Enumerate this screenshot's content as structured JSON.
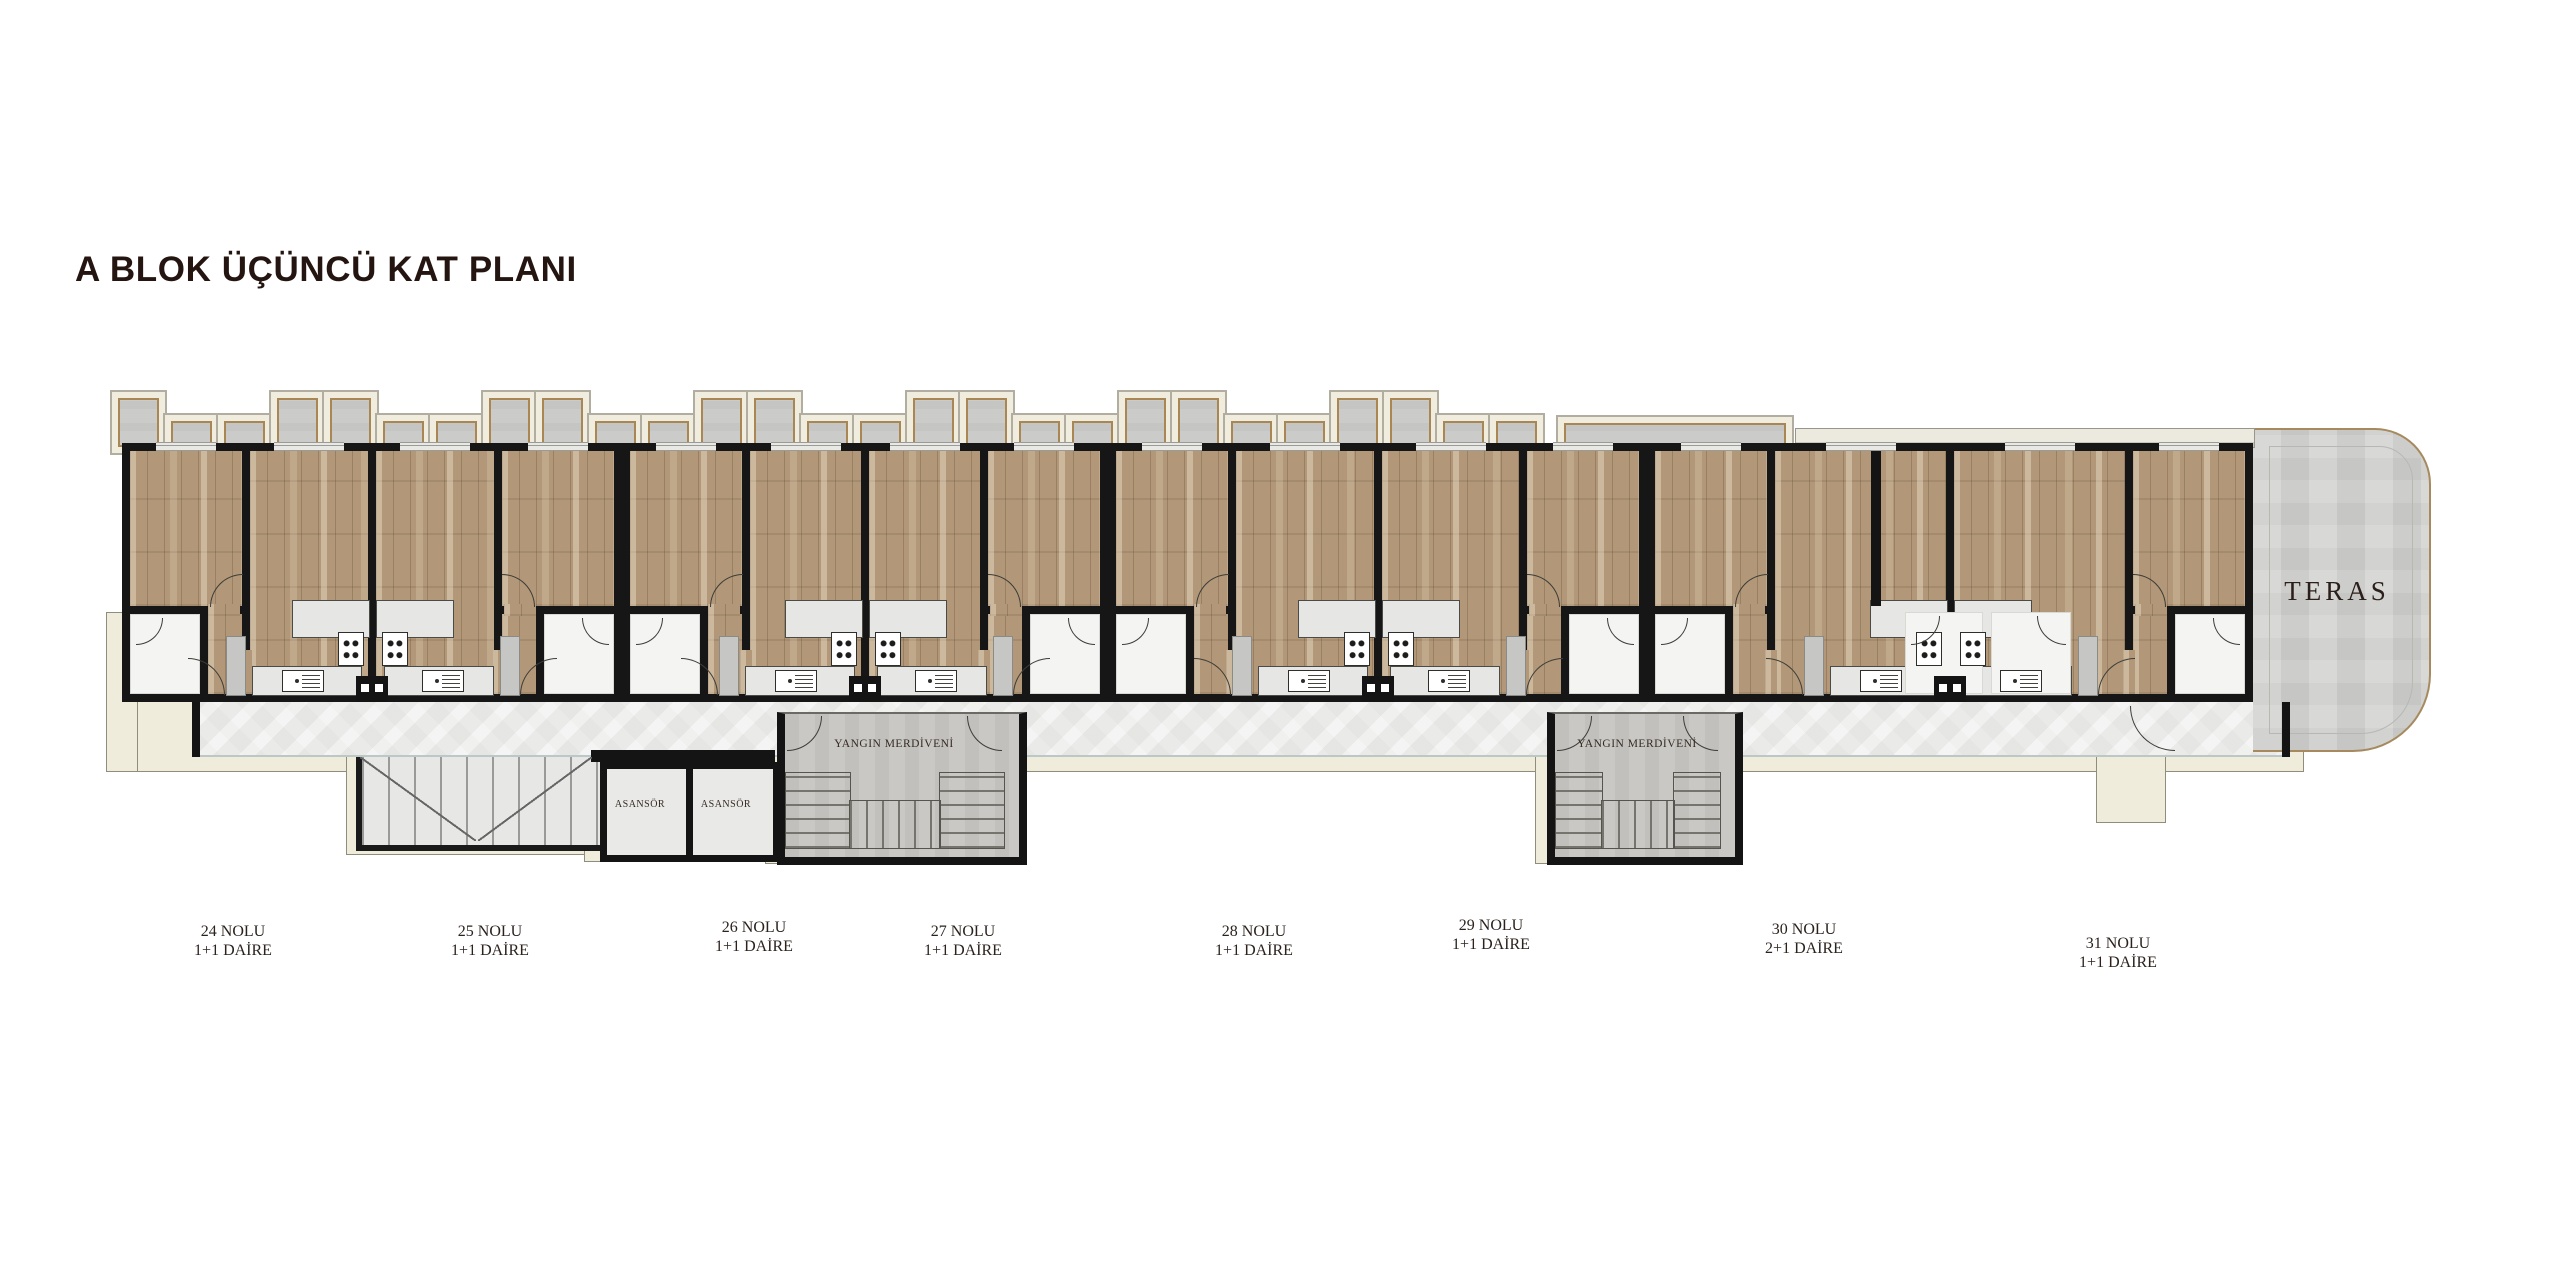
{
  "title": "A BLOK ÜÇÜNCÜ KAT PLANI",
  "apartments": [
    {
      "number": "24 NOLU",
      "type": "1+1 DAİRE"
    },
    {
      "number": "25 NOLU",
      "type": "1+1 DAİRE"
    },
    {
      "number": "26 NOLU",
      "type": "1+1 DAİRE"
    },
    {
      "number": "27 NOLU",
      "type": "1+1 DAİRE"
    },
    {
      "number": "28 NOLU",
      "type": "1+1 DAİRE"
    },
    {
      "number": "29 NOLU",
      "type": "1+1 DAİRE"
    },
    {
      "number": "30 NOLU",
      "type": "2+1 DAİRE"
    },
    {
      "number": "31 NOLU",
      "type": "1+1 DAİRE"
    }
  ],
  "labels": {
    "terrace": "TERAS",
    "elevator1": "ASANSÖR",
    "elevator2": "ASANSÖR",
    "fire_stairs1": "YANGIN MERDİVENİ",
    "fire_stairs2": "YANGIN MERDİVENİ"
  },
  "colors": {
    "wall": "#141414",
    "wood_floor": "#b29878",
    "balcony": "#cbcbc9",
    "corridor": "#eaeae8",
    "frame_cream": "#f1edde",
    "frame_trim": "#a98755",
    "title_text": "#241511",
    "label_text": "#2b221e"
  }
}
